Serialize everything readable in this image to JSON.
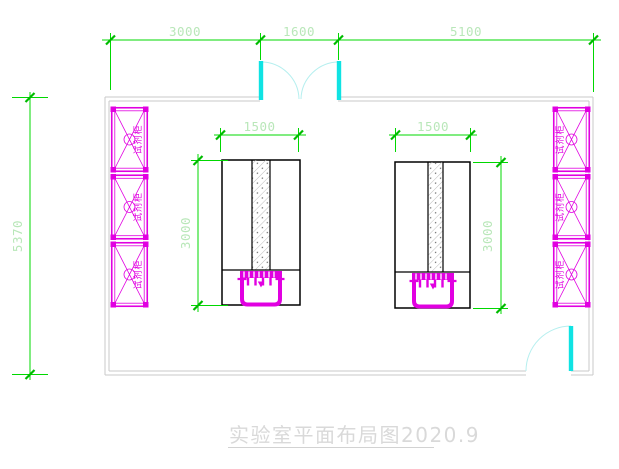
{
  "drawing": {
    "title": "实验室平面布局图2020.9"
  },
  "dimensions": {
    "top_segments": [
      {
        "label": "3000"
      },
      {
        "label": "1600"
      },
      {
        "label": "5100"
      }
    ],
    "overall_height": "5370",
    "bench_width": "1500",
    "bench_depth": "3000"
  },
  "cabinets": {
    "label": "试剂柜",
    "left_count": 3,
    "right_count": 3
  },
  "colors": {
    "dimension_green": "#00d800",
    "dimension_text_green": "#b9e7b9",
    "cabinet_magenta": "#e100e1",
    "door_cyan": "#0fe3e3",
    "door_arc_cyan": "#b5efef",
    "wall_gray": "#cacaca",
    "bench_black": "#000000",
    "title_gray": "#d9d9d9"
  }
}
